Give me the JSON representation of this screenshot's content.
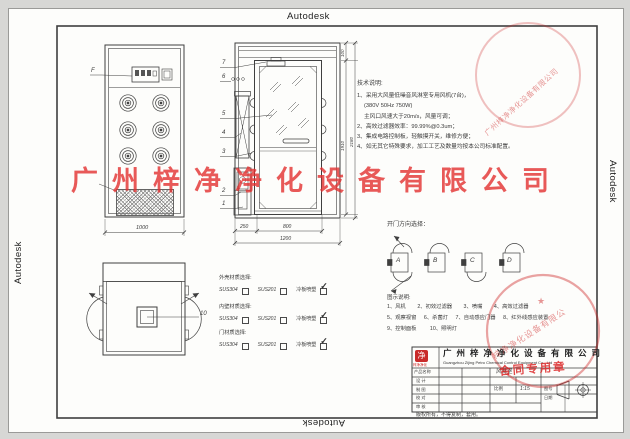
{
  "frame": {
    "autodesk_label": "Autodesk"
  },
  "watermarks": {
    "center_company": "广州梓净净化设备有限公司",
    "seal_company_short": "梓净净化设备有限公",
    "seal_company_full": "广州梓净净化设备有限公司",
    "contract_stamp": "合同专用章",
    "seal_star": "★",
    "red_color": "#cc2323"
  },
  "tech_notes": {
    "title": "技术说明:",
    "lines": [
      "1、采用大风量低噪音风淋室专用风机(7台)，",
      "(380V 50Hz 750W)",
      "主风口风速大于20m/s，风量可调；",
      "2、高效过滤器效率：99.99%@0.3um；",
      "3、集成电路控制板，轻触摸开关，维修方便；",
      "4、如无其它特殊要求，加工工艺及数量均按本公司标准配置。"
    ]
  },
  "door_direction": {
    "title": "开门方向选择：",
    "options": [
      "A",
      "B",
      "C",
      "D"
    ]
  },
  "materials": {
    "checkbox_checked_mark": "✓",
    "groups": [
      {
        "title": "外壳材质选择:",
        "opt1": "SUS304",
        "opt2": "SUS201",
        "opt3": "冷板喷塑"
      },
      {
        "title": "内壁材质选择:",
        "opt1": "SUS304",
        "opt2": "SUS201",
        "opt3": "冷板喷塑"
      },
      {
        "title": "门材质选择:",
        "opt1": "SUS304",
        "opt2": "SUS201",
        "opt3": "冷板喷塑"
      }
    ]
  },
  "legend": {
    "title": "图示说明:",
    "items": [
      "1、风机",
      "2、初效过滤器",
      "3、喷嘴",
      "4、高效过滤器",
      "5、观察视窗",
      "6、杀菌灯",
      "7、自动感应门器",
      "8、红外线感应装置",
      "9、控制面板",
      "10、照明灯"
    ]
  },
  "callouts": {
    "front_panel": "F",
    "side": [
      "7",
      "6",
      "5",
      "4",
      "3",
      "2",
      "1"
    ],
    "top_lamp": "10"
  },
  "dimensions": {
    "front_width": "1000",
    "side_left": "250",
    "side_door": "800",
    "side_total": "1200",
    "door_height": "1910",
    "total_height": "2180",
    "top_cap": "100"
  },
  "title_block": {
    "logo_char": "净",
    "logo_sub": "梓净净化",
    "company_cn": "广州梓净净化设备有限公司",
    "company_en": "Guangzhou Zijing Petro Chemical Control Equipment Co., Ltd",
    "product_label": "产品名称",
    "product_value": "风淋室",
    "design_label": "设 计",
    "draft_label": "制 图",
    "check_label": "校 对",
    "audit_label": "审 核",
    "scale_label": "比例",
    "scale_value": "1:15",
    "drawing_no_label": "图号",
    "date_label": "日期",
    "copyright": "版权所有，不得复制，套用。"
  }
}
